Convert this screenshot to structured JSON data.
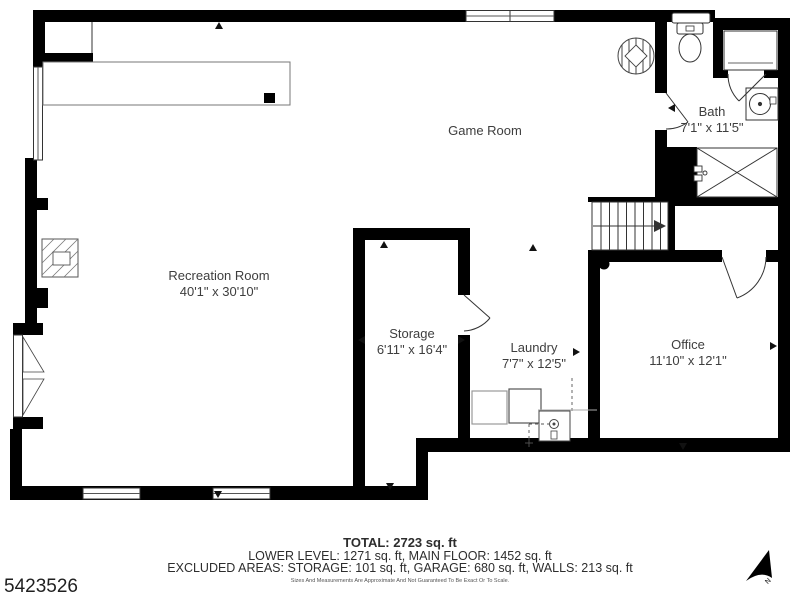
{
  "plan": {
    "rooms": {
      "game_room": {
        "name": "Game Room",
        "dims": ""
      },
      "recreation_room": {
        "name": "Recreation Room",
        "dims": "40'1\" x 30'10\""
      },
      "bath": {
        "name": "Bath",
        "dims": "7'1\" x 11'5\""
      },
      "storage": {
        "name": "Storage",
        "dims": "6'11\" x 16'4\""
      },
      "laundry": {
        "name": "Laundry",
        "dims": "7'7\" x 12'5\""
      },
      "office": {
        "name": "Office",
        "dims": "11'10\" x 12'1\""
      }
    },
    "wall_color": "#000000",
    "line_color": "#3a3a3a"
  },
  "footer": {
    "total": "TOTAL: 2723 sq. ft",
    "levels": "LOWER LEVEL: 1271 sq. ft, MAIN FLOOR: 1452 sq. ft",
    "excluded": "EXCLUDED AREAS: STORAGE: 101 sq. ft, GARAGE: 680 sq. ft, WALLS: 213 sq. ft",
    "disclaimer": "Sizes And Measurements Are Approximate And Not Guaranteed To Be Exact Or To Scale."
  },
  "listing_id": "5423526",
  "compass": {
    "label": "N"
  }
}
